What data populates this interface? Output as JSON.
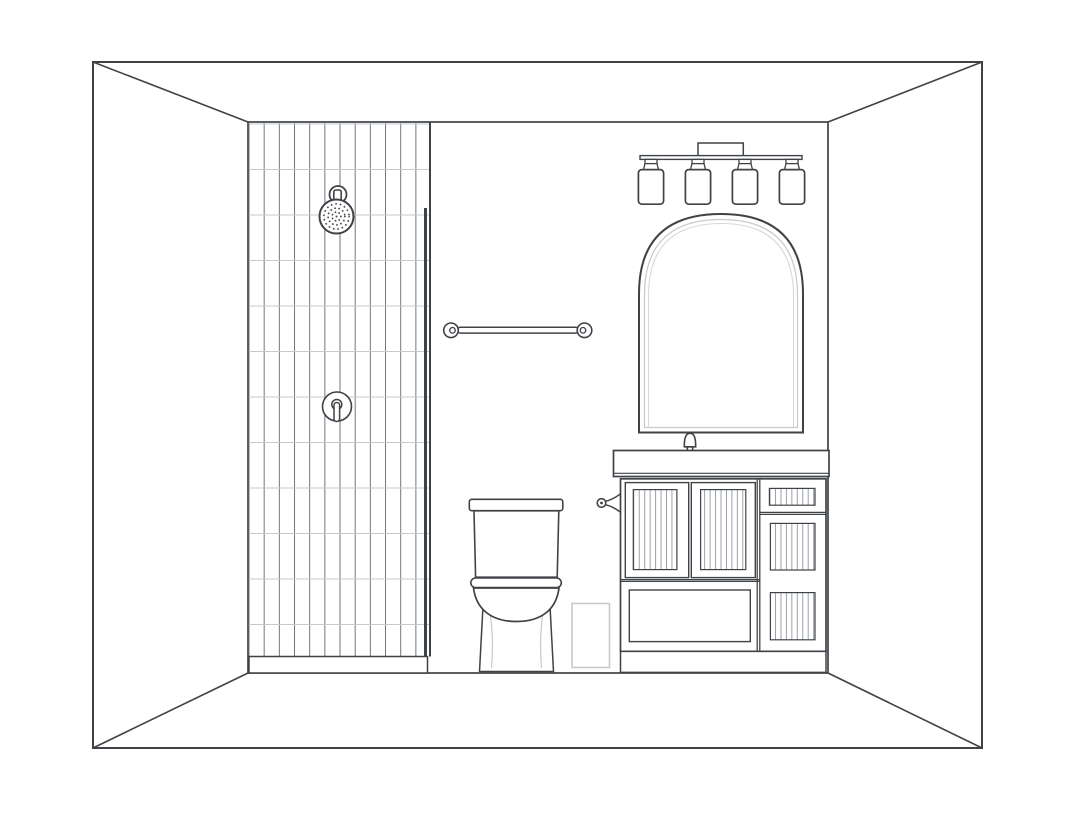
{
  "page": {
    "title": "Bathroom Elevation Line Drawing",
    "background": "#ffffff"
  },
  "colors": {
    "background": "#ffffff",
    "line_dark": "#3f4347",
    "line_mid": "#70767c",
    "line_light": "#c6cacd",
    "line_faint": "#d6d9db"
  },
  "scene": {
    "room": {
      "kind": "interior elevation, one-point perspective"
    },
    "shower": {
      "tile_orientation": "vertical stacked tiles",
      "tile_columns": 12,
      "tile_rows": 12,
      "has_curb": true
    },
    "shower_head": {
      "style": "round head with dotted spray face"
    },
    "shower_valve": {
      "style": "round escutcheon with single lever"
    },
    "glass_panel": {
      "style": "frameless fixed panel"
    },
    "towel_bar": {
      "mount_posts": 2
    },
    "toilet": {
      "style": "two-piece, tank with lid, round bowl, pedestal base"
    },
    "waste_bin": {
      "style": "small rectangular bin"
    },
    "vanity_light": {
      "bulb_count": 4,
      "shade_style": "cylinder shades on bar"
    },
    "mirror": {
      "shape": "arched, double inner frame line"
    },
    "faucet": {
      "handle_count": 2,
      "style": "widespread with curved spout"
    },
    "towel_hook": {
      "style": "side-mounted knob holder"
    },
    "vanity_cabinet": {
      "door_count": 2,
      "side_drawer_count": 3,
      "bottom_drawer_count": 1,
      "panel_style": "beadboard"
    }
  }
}
